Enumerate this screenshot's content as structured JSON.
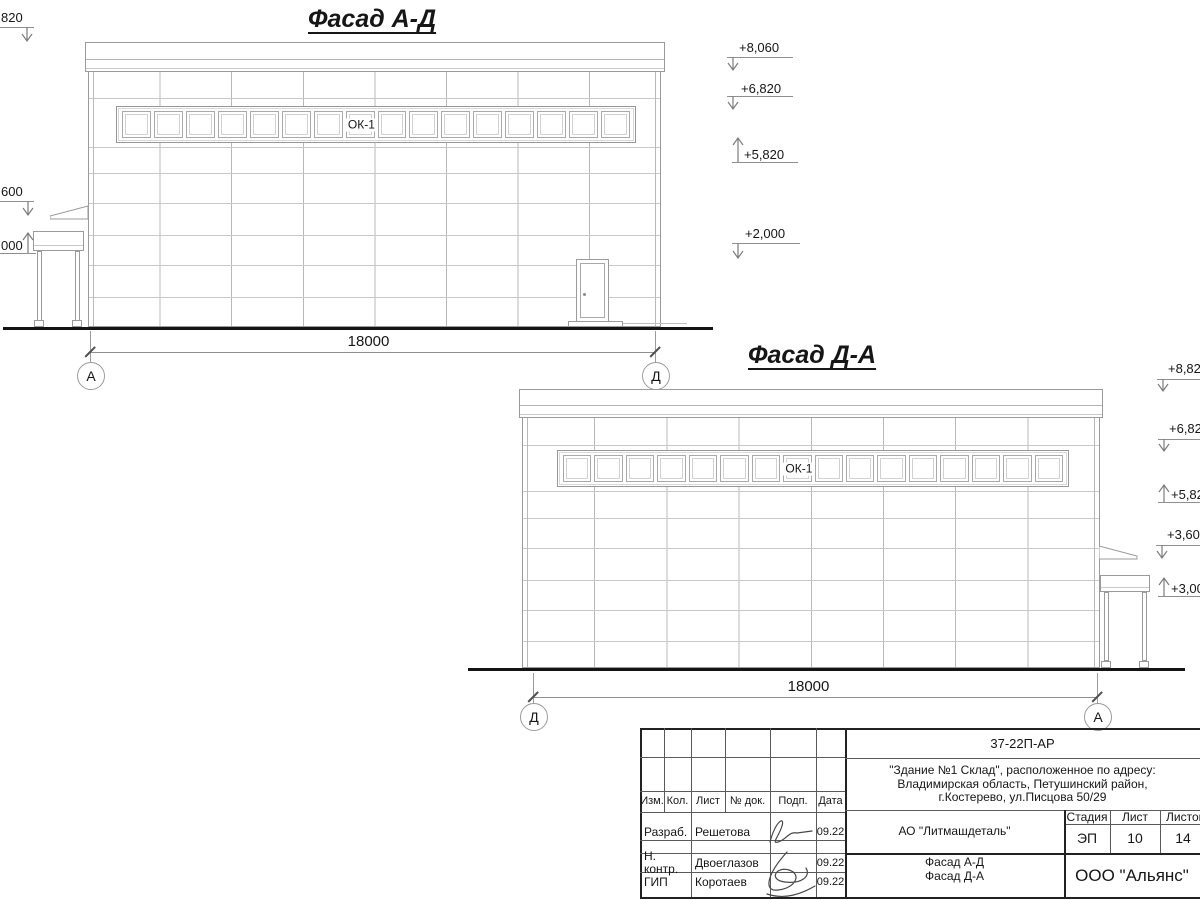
{
  "facades": {
    "window_pane_count": 16,
    "ad": {
      "title": "Фасад А-Д",
      "window_label": "ОК-1",
      "dimension": "18000",
      "axis_start": "А",
      "axis_end": "Д",
      "elev_left": [
        "820",
        "600",
        "000"
      ],
      "elev_right": [
        "+8,060",
        "+6,820",
        "+5,820",
        "+2,000"
      ]
    },
    "da": {
      "title": "Фасад Д-А",
      "window_label": "ОК-1",
      "dimension": "18000",
      "axis_start": "Д",
      "axis_end": "А",
      "elev_right": [
        "+8,82",
        "+6,82",
        "+5,82",
        "+3,60",
        "+3,00"
      ]
    }
  },
  "titleblock": {
    "doc_number": "37-22П-АР",
    "address_line1": "\"Здание №1 Склад\", расположенное по адресу:",
    "address_line2": "Владимирская область, Петушинский район,",
    "address_line3": "г.Костерево, ул.Писцова 50/29",
    "client": "АО \"Литмашдеталь\"",
    "stage_label": "Стадия",
    "sheet_label": "Лист",
    "sheets_label": "Листов",
    "stage": "ЭП",
    "sheet": "10",
    "sheets": "14",
    "sheet_title_line1": "Фасад А-Д",
    "sheet_title_line2": "Фасад Д-А",
    "company": "ООО \"Альянс\"",
    "rev_headers": [
      "Изм.",
      "Кол.",
      "Лист",
      "№ док.",
      "Подп.",
      "Дата"
    ],
    "roles": [
      {
        "role": "Разраб.",
        "name": "Решетова",
        "date": "09.22"
      },
      {
        "role": "Н. контр.",
        "name": "Двоеглазов",
        "date": "09.22"
      },
      {
        "role": "ГИП",
        "name": "Коротаев",
        "date": "09.22"
      }
    ]
  }
}
